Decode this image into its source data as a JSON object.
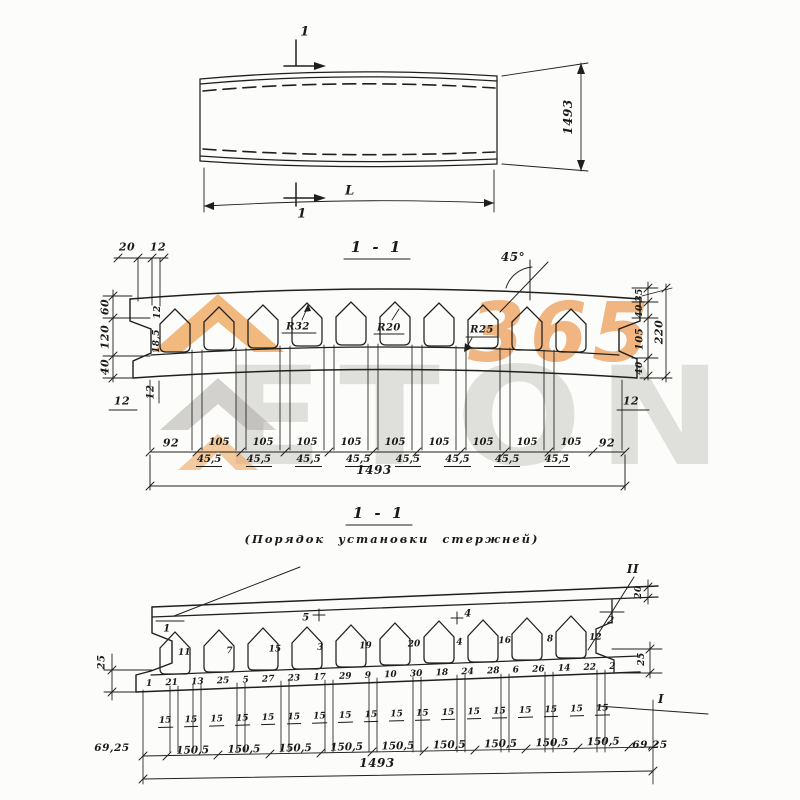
{
  "watermark": {
    "letters": "ETON",
    "number": "365"
  },
  "plan_view": {
    "cut_mark_top": "1",
    "cut_mark_bottom": "1",
    "length_label": "L",
    "width_dim": "1493"
  },
  "section_1_1": {
    "title": "1 - 1",
    "top_dims": [
      "20",
      "12"
    ],
    "left_dims": [
      "60",
      "120",
      "40"
    ],
    "rib_dims": [
      "12",
      "18,5"
    ],
    "left_below_dim": "12",
    "left_bottom_dim": "12",
    "radius_labels": [
      "R32",
      "R20",
      "R25"
    ],
    "angle_label": "45°",
    "right_dims": {
      "d35": "35",
      "d40_top": "40",
      "d105": "105",
      "d220": "220",
      "d40_bottom": "40",
      "d12": "12"
    },
    "bottom_row": {
      "edge_left": "92",
      "spacings": [
        "105",
        "105",
        "105",
        "105",
        "105",
        "105",
        "105",
        "105",
        "105"
      ],
      "offsets": [
        "45,5",
        "45,5",
        "45,5",
        "45,5",
        "45,5",
        "45,5",
        "45,5",
        "45,5"
      ],
      "edge_right": "92",
      "total": "1493"
    }
  },
  "placement_view": {
    "title": "1 - 1",
    "subtitle": "(Порядок установки стержней)",
    "marks": {
      "rod_left": "1",
      "rod_right": "2",
      "slab_left": "5",
      "slab_right": "4",
      "roman_top": "II",
      "roman_bottom": "I"
    },
    "upper_numbers": [
      "11",
      "7",
      "15",
      "3",
      "19",
      "20",
      "4",
      "16",
      "8",
      "12"
    ],
    "lower_numbers": [
      "1",
      "21",
      "13",
      "25",
      "5",
      "27",
      "23",
      "17",
      "29",
      "9",
      "10",
      "30",
      "18",
      "24",
      "28",
      "6",
      "26",
      "14",
      "22",
      "2"
    ],
    "left_dim": "25",
    "right_dim_top": "20",
    "right_dim_bottom": "25",
    "cover_dims": [
      "15",
      "15",
      "15",
      "15",
      "15",
      "15",
      "15",
      "15",
      "15",
      "15",
      "15",
      "15",
      "15",
      "15",
      "15",
      "15",
      "15",
      "15"
    ],
    "spacings": [
      "150,5",
      "150,5",
      "150,5",
      "150,5",
      "150,5",
      "150,5",
      "150,5",
      "150,5",
      "150,5"
    ],
    "edge_left": "69,25",
    "edge_right": "69,25",
    "total": "1493"
  }
}
